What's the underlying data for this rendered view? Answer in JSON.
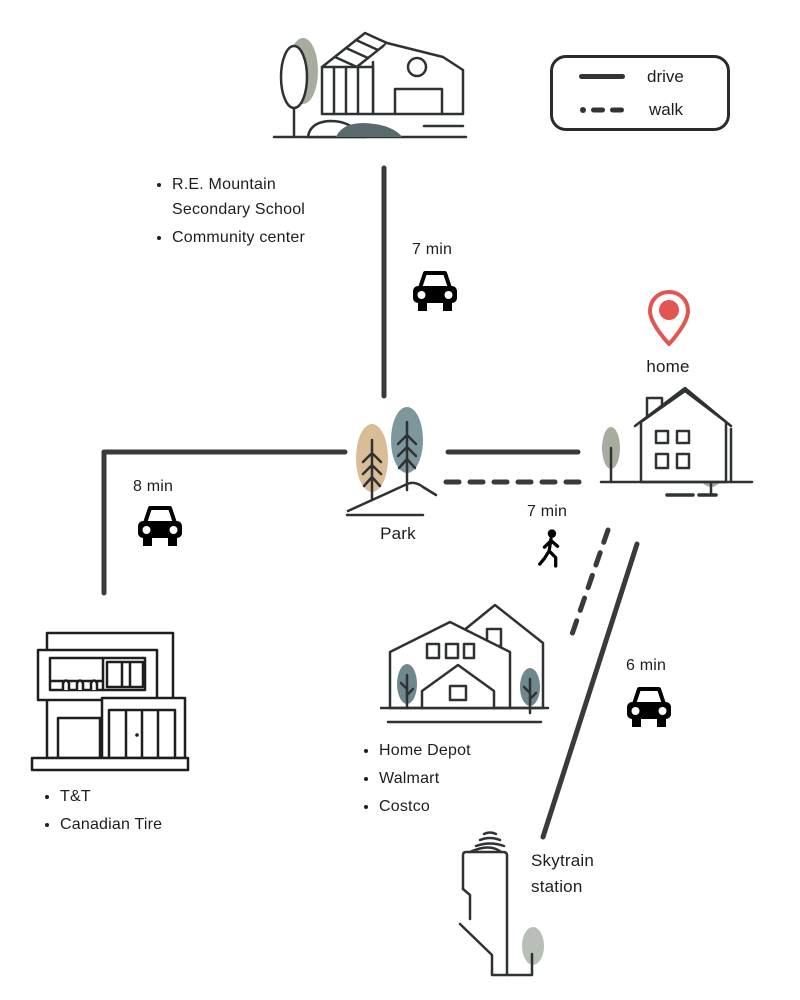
{
  "palette": {
    "ink": "#2f3234",
    "route_line": "#3a3a3a",
    "pin_red": "#e25550",
    "sage": "#a7ad9e",
    "tan": "#d8bd97",
    "slate": "#7e979c",
    "teal": "#6e888e",
    "dark_slate": "#5b6a6c",
    "light_sage": "#b7bfb7"
  },
  "icons": {
    "drive": "car-icon",
    "walk": "pedestrian-icon",
    "home": "map-pin-icon"
  },
  "legend": {
    "drive": "drive",
    "walk": "walk"
  },
  "labels": {
    "home": "home",
    "park": "Park",
    "skytrain": "Skytrain station"
  },
  "routes": {
    "school_drive": {
      "time": "7 min",
      "mode": "drive"
    },
    "west_shops_drive": {
      "time": "8 min",
      "mode": "drive"
    },
    "south_shops_walk": {
      "time": "7 min",
      "mode": "walk"
    },
    "skytrain_drive": {
      "time": "6 min",
      "mode": "drive"
    }
  },
  "places": {
    "school": {
      "items": [
        "R.E. Mountain Secondary School",
        "Community center"
      ]
    },
    "west_shops": {
      "items": [
        "T&T",
        "Canadian Tire"
      ]
    },
    "south_shops": {
      "items": [
        "Home Depot",
        "Walmart",
        "Costco"
      ]
    }
  }
}
